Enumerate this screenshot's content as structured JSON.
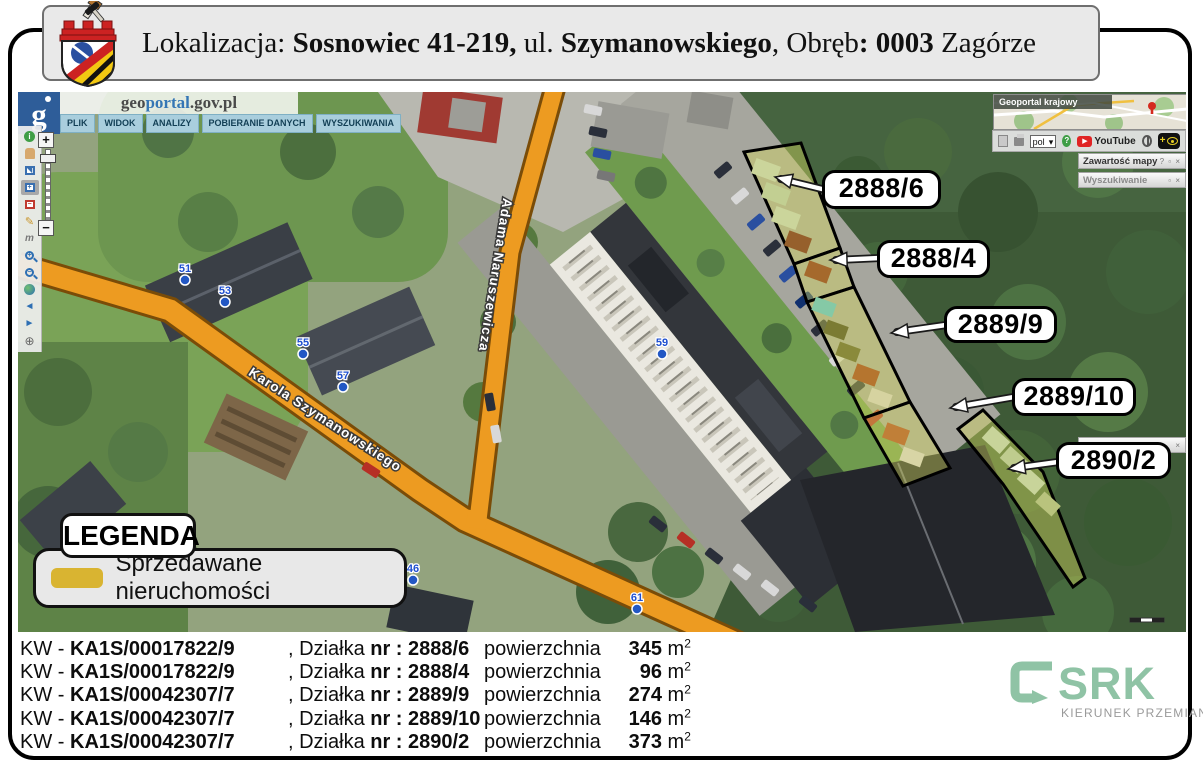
{
  "header": {
    "seg_lokalizacja": "Lokalizacja: ",
    "seg_city": "Sosnowiec 41-219,",
    "seg_ul": " ul. ",
    "seg_street": "Szymanowskiego",
    "seg_obreb": ", Obręb",
    "seg_obreb_val": ": 0003",
    "seg_district": " Zagórze"
  },
  "geoportal": {
    "logo_g": "g",
    "brand_geo": "geo",
    "brand_portal": "portal",
    "brand_suffix": ".gov.pl",
    "menu": {
      "plik": "PLIK",
      "widok": "WIDOK",
      "analizy": "ANALIZY",
      "pobieranie": "POBIERANIE DANYCH",
      "wyszukiwania": "WYSZUKIWANIA"
    },
    "zoom_plus": "+",
    "zoom_minus": "−",
    "lang_value": "pol",
    "lang_caret": "▾",
    "youtube_label": "YouTube",
    "overview_title": "Geoportal krajowy",
    "panel_map_contents": "Zawartość mapy",
    "panel_map_contents_icons": "? ▫ ×",
    "panel_search": "Wyszukiwanie",
    "panel_search_icons": "▫ ×",
    "panel_hidden_icons": "×"
  },
  "map": {
    "streets": {
      "szymanowskiego": "Karola Szymanowskiego",
      "naruszewicza": "Adama Naruszewicza"
    },
    "house_numbers": {
      "n51": "51",
      "n53": "53",
      "n55": "55",
      "n57": "57",
      "n59": "59",
      "n61": "61",
      "n46": "46"
    },
    "parcel_labels": {
      "p1": "2888/6",
      "p2": "2888/4",
      "p3": "2889/9",
      "p4": "2889/10",
      "p5": "2890/2"
    }
  },
  "legend": {
    "title": "LEGENDA",
    "item_label": "Sprzedawane nieruchomości",
    "swatch_color": "#d9b431"
  },
  "listing": {
    "kw_prefix": "KW - ",
    "dzialka_label": ", Działka ",
    "nr_label": "nr : ",
    "area_label": "powierzchnia ",
    "unit": " m",
    "unit_exp": "2",
    "rows": [
      {
        "kw": "KA1S/00017822/9",
        "nr": "2888/6",
        "area": "345"
      },
      {
        "kw": "KA1S/00017822/9",
        "nr": "2888/4",
        "area": "96"
      },
      {
        "kw": "KA1S/00042307/7",
        "nr": "2889/9",
        "area": "274"
      },
      {
        "kw": "KA1S/00042307/7",
        "nr": "2889/10",
        "area": "146"
      },
      {
        "kw": "KA1S/00042307/7",
        "nr": "2890/2",
        "area": "373"
      }
    ]
  },
  "branding": {
    "name": "SRK",
    "tagline": "KIERUNEK PRZEMIAN",
    "accent_color": "#8fc3a5"
  },
  "colors": {
    "road_orange": "#ed9b21",
    "parcel_fill": "#d6d95e",
    "parcel_outline": "#000000",
    "marker_blue": "#2257c4",
    "header_bg": "#e9e9e9"
  }
}
